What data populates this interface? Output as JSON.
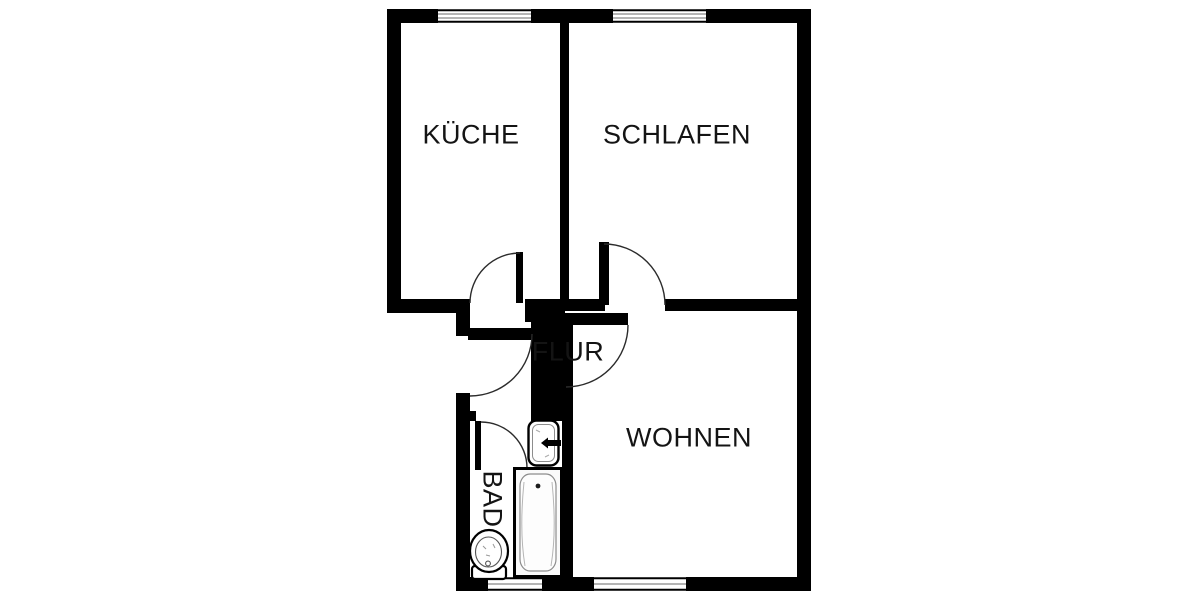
{
  "plan": {
    "type": "apartment-floor-plan",
    "rooms": {
      "kueche": {
        "label": "KÜCHE"
      },
      "schlafen": {
        "label": "SCHLAFEN"
      },
      "flur": {
        "label": "FLUR"
      },
      "wohnen": {
        "label": "WOHNEN"
      },
      "bad": {
        "label": "BAD"
      }
    },
    "fixtures": [
      {
        "icon": "bathtub-icon"
      },
      {
        "icon": "washbasin-icon"
      },
      {
        "icon": "toilet-icon"
      }
    ],
    "doors": [
      {
        "name": "kueche-door"
      },
      {
        "name": "schlafen-door"
      },
      {
        "name": "wohnen-door"
      },
      {
        "name": "bad-door"
      },
      {
        "name": "entrance-door"
      }
    ],
    "windows": [
      {
        "name": "kueche-window",
        "wall": "top"
      },
      {
        "name": "schlafen-window",
        "wall": "top"
      },
      {
        "name": "bad-window",
        "wall": "bottom"
      },
      {
        "name": "wohnen-window",
        "wall": "bottom"
      }
    ],
    "colors": {
      "wall": "#000000",
      "background": "#ffffff",
      "door_arc": "#2b2b2b",
      "window_line": "#9b9b9b",
      "text": "#141414"
    }
  }
}
